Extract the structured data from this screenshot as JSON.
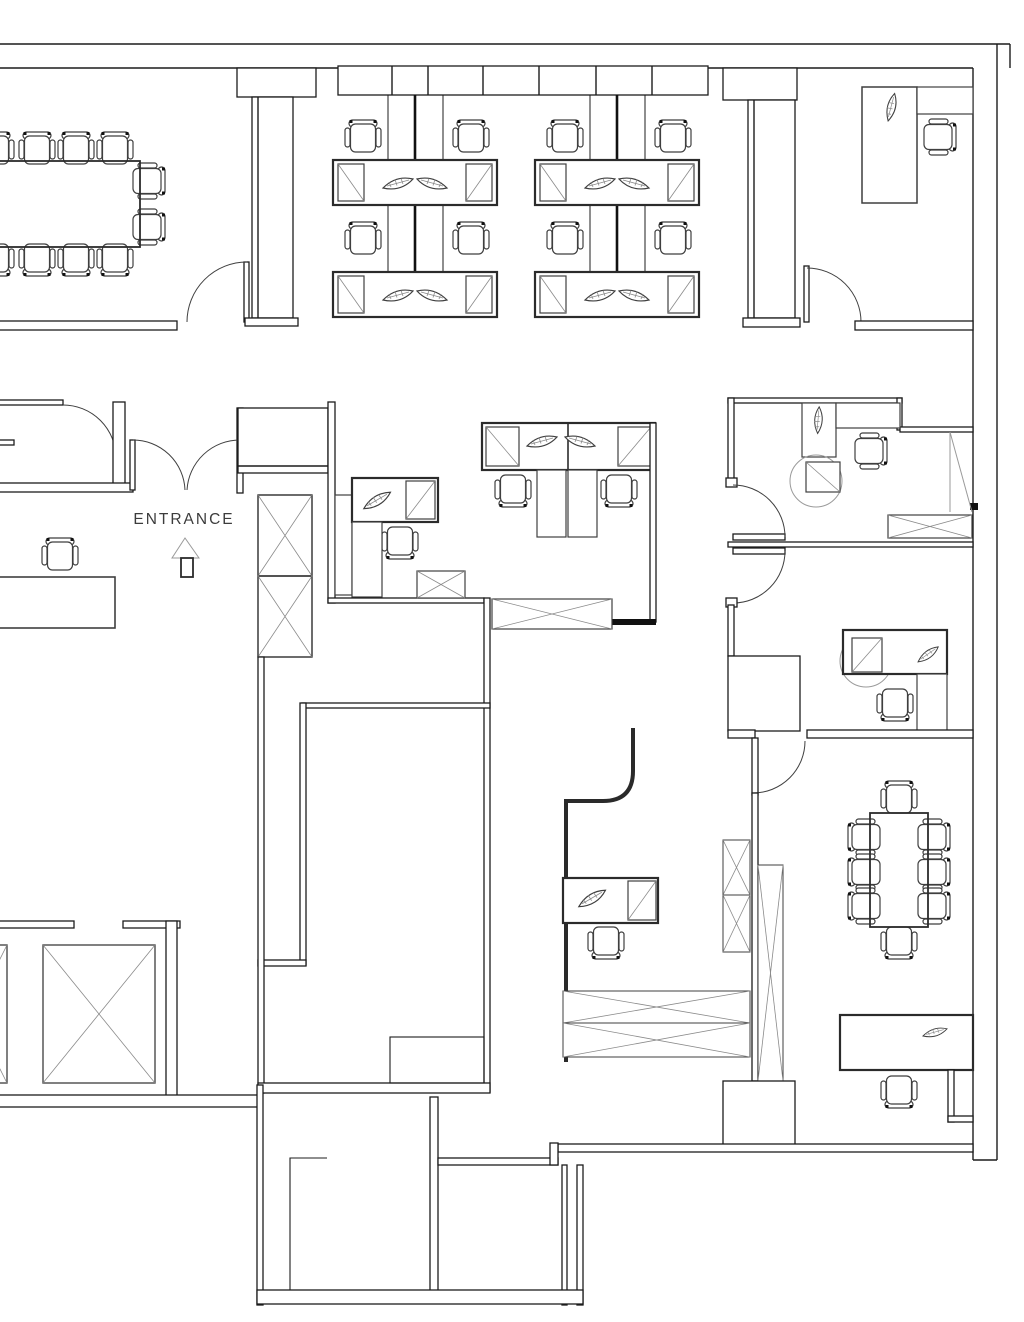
{
  "document": {
    "type": "architectural floor plan",
    "view": "top-down CAD line drawing",
    "background": "#ffffff"
  },
  "labels": {
    "entrance": "ENTRANCE"
  },
  "palette": {
    "wall": "#1c1c1c",
    "furniture": "#3f3f3f",
    "detail": "#8a8a8a",
    "label_text": "#3c3c3c",
    "background": "#ffffff"
  },
  "plan": {
    "rooms": [
      {
        "name": "conference-room-nw",
        "furniture": {
          "long_table": 1,
          "chairs": 10
        }
      },
      {
        "name": "open-office-north",
        "furniture": {
          "workstation_clusters": 2,
          "desk_benches": 4,
          "task_chairs": 8,
          "desk_plants": 8,
          "end_cabinets": 8,
          "wall_cabinet_units": 7
        }
      },
      {
        "name": "private-office-ne",
        "furniture": {
          "desk": 1,
          "side_cabinet": 1,
          "chair": 1,
          "plant": 1,
          "door": 1
        }
      },
      {
        "name": "entrance-lobby",
        "furniture": {
          "double_entry_door": 1,
          "entrance_label": 1,
          "direction_arrow": 1,
          "braced_shaft": 1,
          "closet": 1,
          "reception_desk": 1,
          "chair": 1,
          "office_door": 1
        }
      },
      {
        "name": "open-area-middle",
        "furniture": {
          "single_workstation": 1,
          "double_workstation": 1,
          "chairs": 3,
          "plants": 3,
          "crossed_cabinets": 2
        }
      },
      {
        "name": "office-east-1",
        "furniture": {
          "l_desk": 1,
          "chair": 1,
          "plant": 1,
          "round_mat": 1,
          "crossed_sideboard": 1,
          "corner_wardrobe": 1,
          "doors": 2
        }
      },
      {
        "name": "office-east-2",
        "furniture": {
          "desk": 1,
          "chair": 1,
          "plant": 1,
          "round_mat": 1,
          "desk_return": 1,
          "closet": 1,
          "door": 1
        }
      },
      {
        "name": "meeting-room-se",
        "furniture": {
          "table": 1,
          "chairs": 8,
          "sideboard_desk": 1,
          "desk_chair": 1,
          "plant": 1,
          "pillar": 1
        }
      },
      {
        "name": "work-nook-center",
        "furniture": {
          "curved_partition": 1,
          "desk": 1,
          "chair": 1,
          "plant": 1,
          "crossed_low_cabinets": 2,
          "crossed_boxes": 2,
          "braced_column": 1
        }
      },
      {
        "name": "central-storage-room",
        "furniture": {}
      },
      {
        "name": "elevator-core-sw",
        "furniture": {
          "elevator_shafts": 2
        }
      },
      {
        "name": "service-rooms-south",
        "furniture": {}
      }
    ]
  }
}
